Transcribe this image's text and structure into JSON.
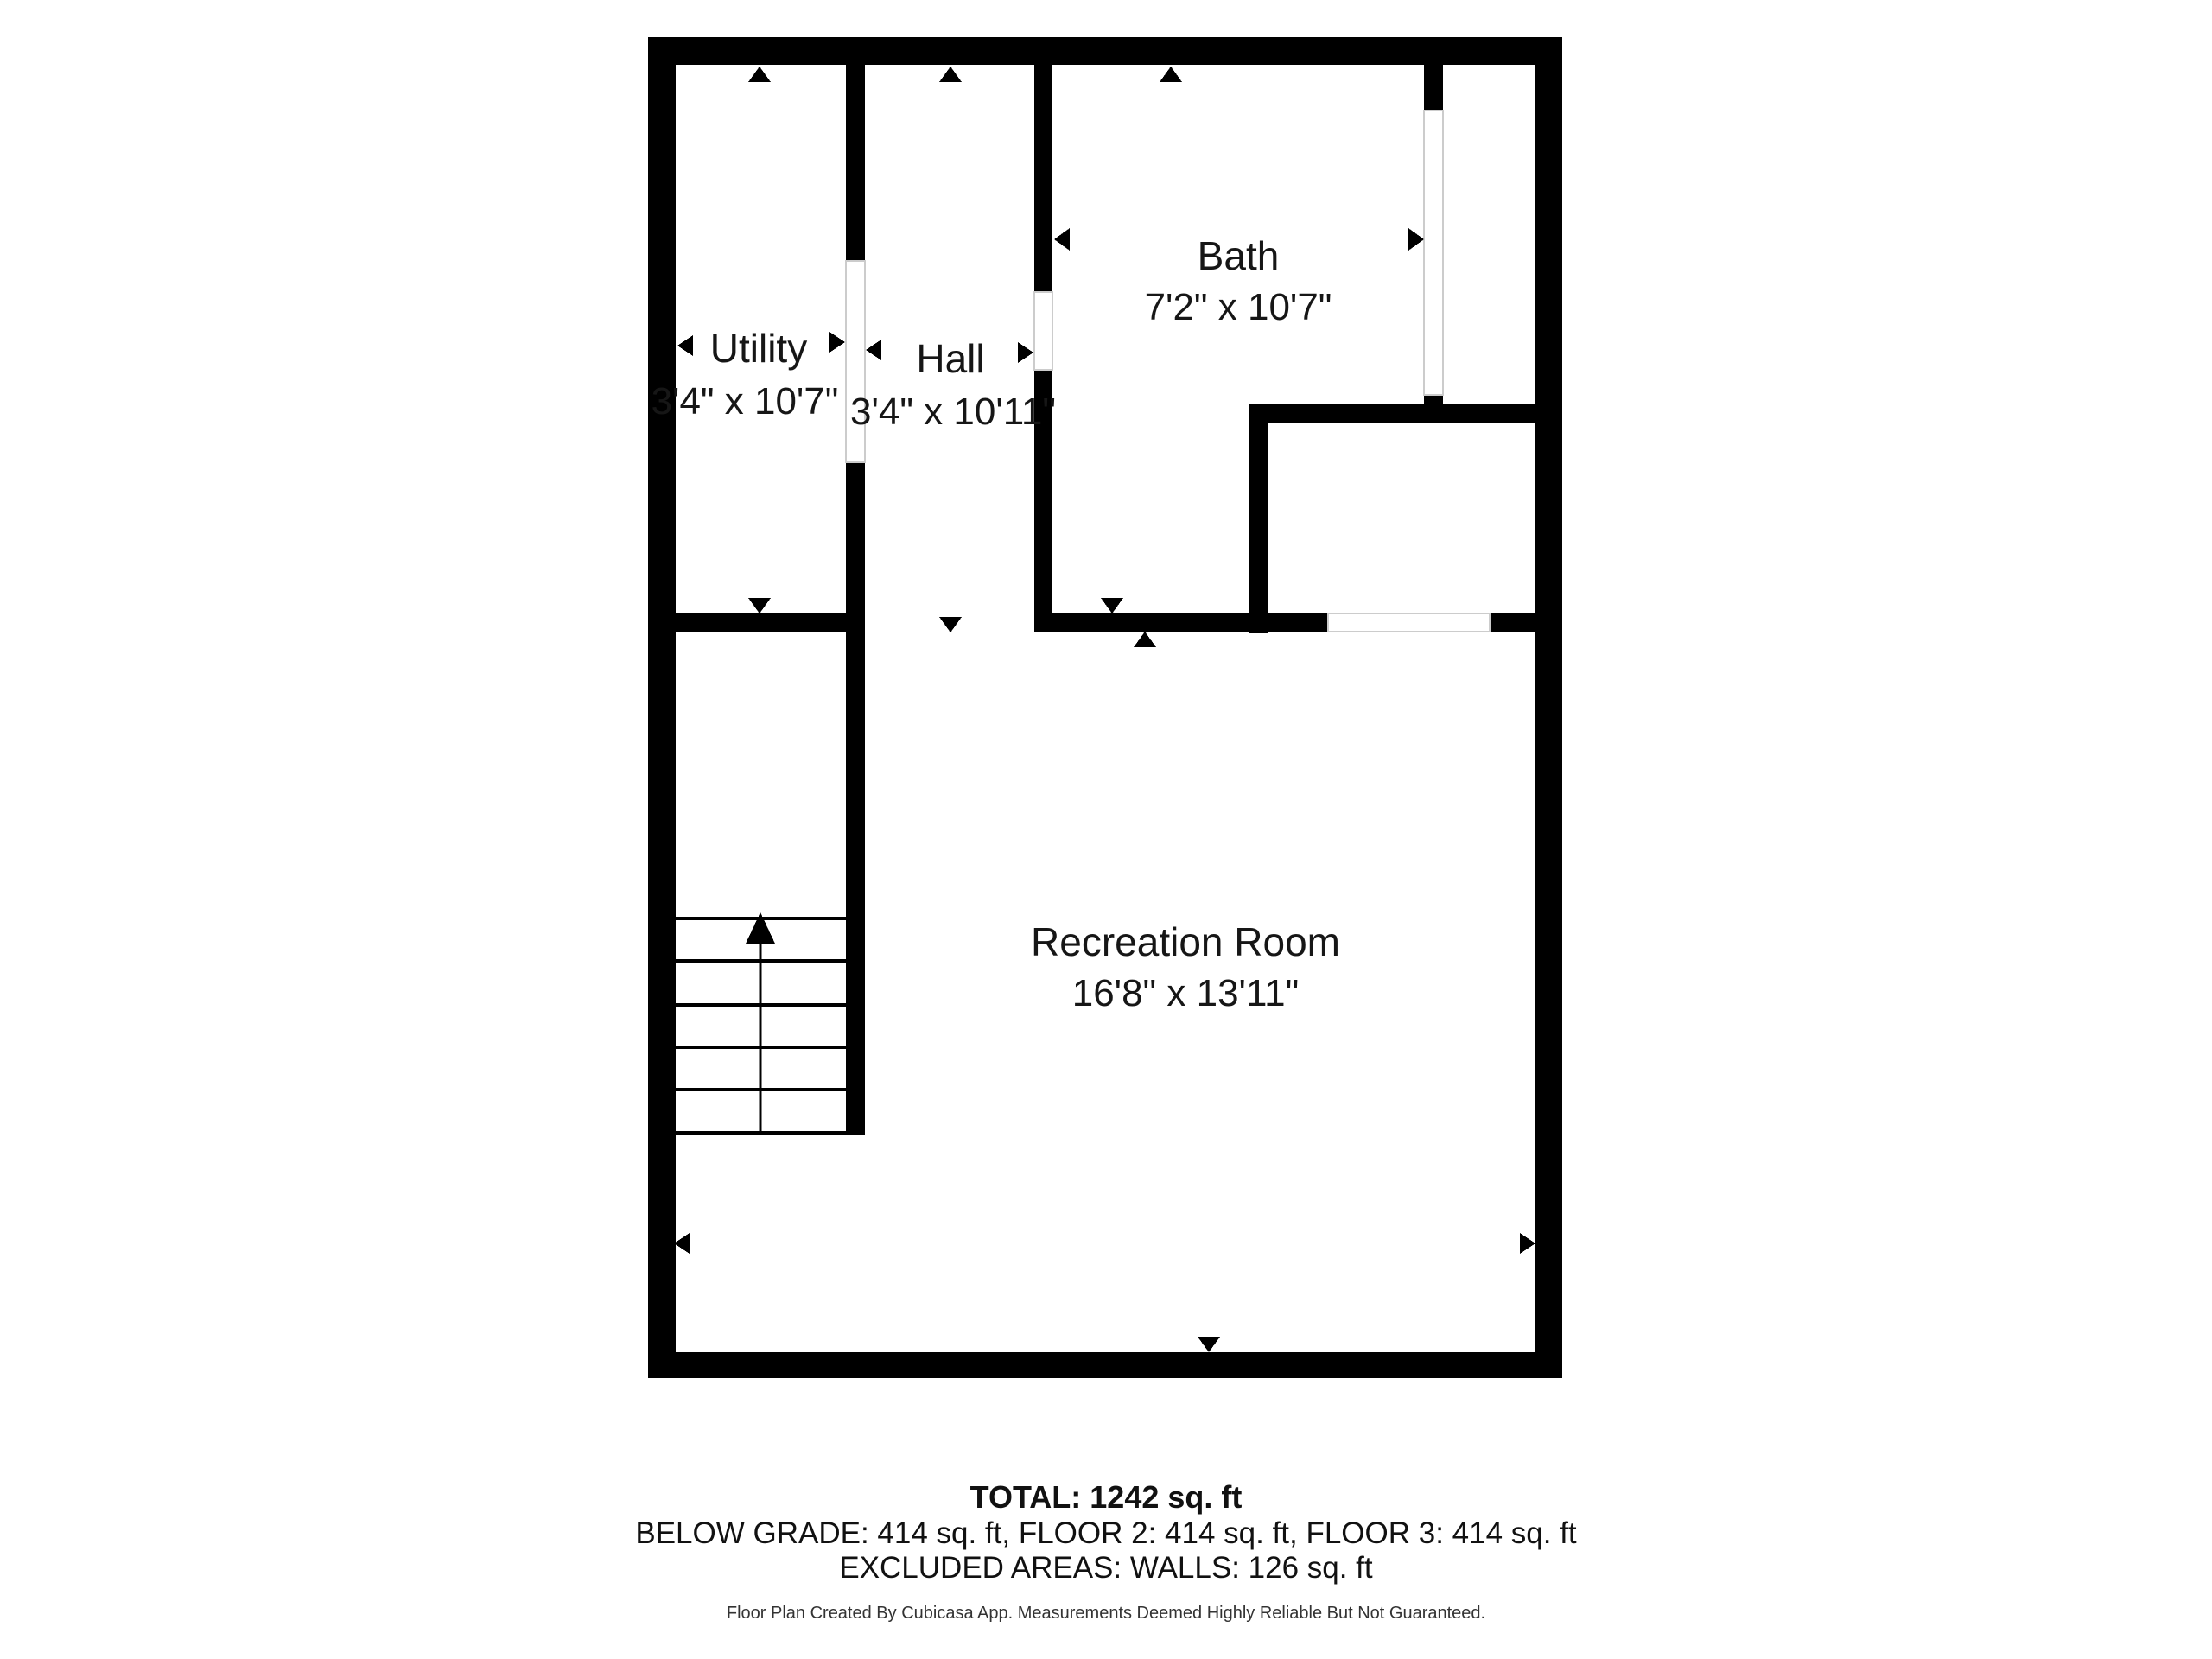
{
  "plan": {
    "type": "floor-plan",
    "floor_shown": "Below Grade",
    "rooms": [
      {
        "name": "Utility",
        "dims": "3'4\" x 10'7\""
      },
      {
        "name": "Hall",
        "dims": "3'4\" x 10'11\""
      },
      {
        "name": "Bath",
        "dims": "7'2\" x 10'7\""
      },
      {
        "name": "Recreation Room",
        "dims": "16'8\" x 13'11\""
      }
    ],
    "stairs": {
      "direction": "up",
      "treads": 6
    }
  },
  "summary": {
    "total": "TOTAL: 1242 sq. ft",
    "total_value_sqft": 1242,
    "floors": "BELOW GRADE: 414 sq. ft, FLOOR 2: 414 sq. ft, FLOOR 3: 414 sq. ft",
    "floor_values_sqft": {
      "below_grade": 414,
      "floor_2": 414,
      "floor_3": 414
    },
    "excluded": "EXCLUDED AREAS: WALLS: 126 sq. ft",
    "excluded_walls_sqft": 126,
    "disclaimer": "Floor Plan Created By Cubicasa App. Measurements Deemed Highly Reliable But Not Guaranteed."
  },
  "colors": {
    "wall": "#000000",
    "background": "#ffffff",
    "text": "#161616",
    "opening_outline": "#cccccc"
  }
}
